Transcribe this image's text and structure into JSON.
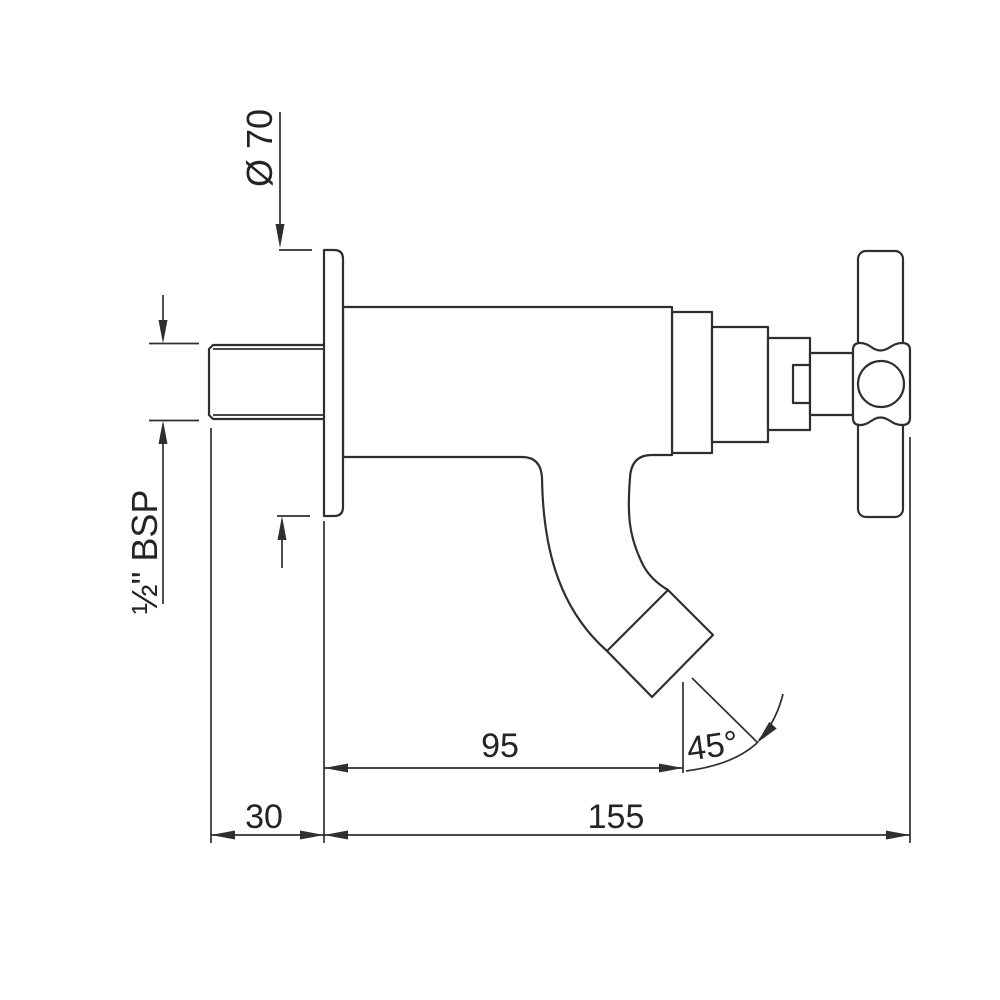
{
  "drawing": {
    "type": "technical-drawing",
    "subject": "wall-mounted bib tap with cross handle, side elevation",
    "background_color": "#ffffff",
    "line_color": "#2f2f2f",
    "annotations": {
      "flange_diameter": "Ø 70",
      "inlet_thread": "½\" BSP",
      "spout_projection": "95",
      "spout_angle": "45°",
      "wall_offset": "30",
      "overall_projection": "155"
    }
  }
}
